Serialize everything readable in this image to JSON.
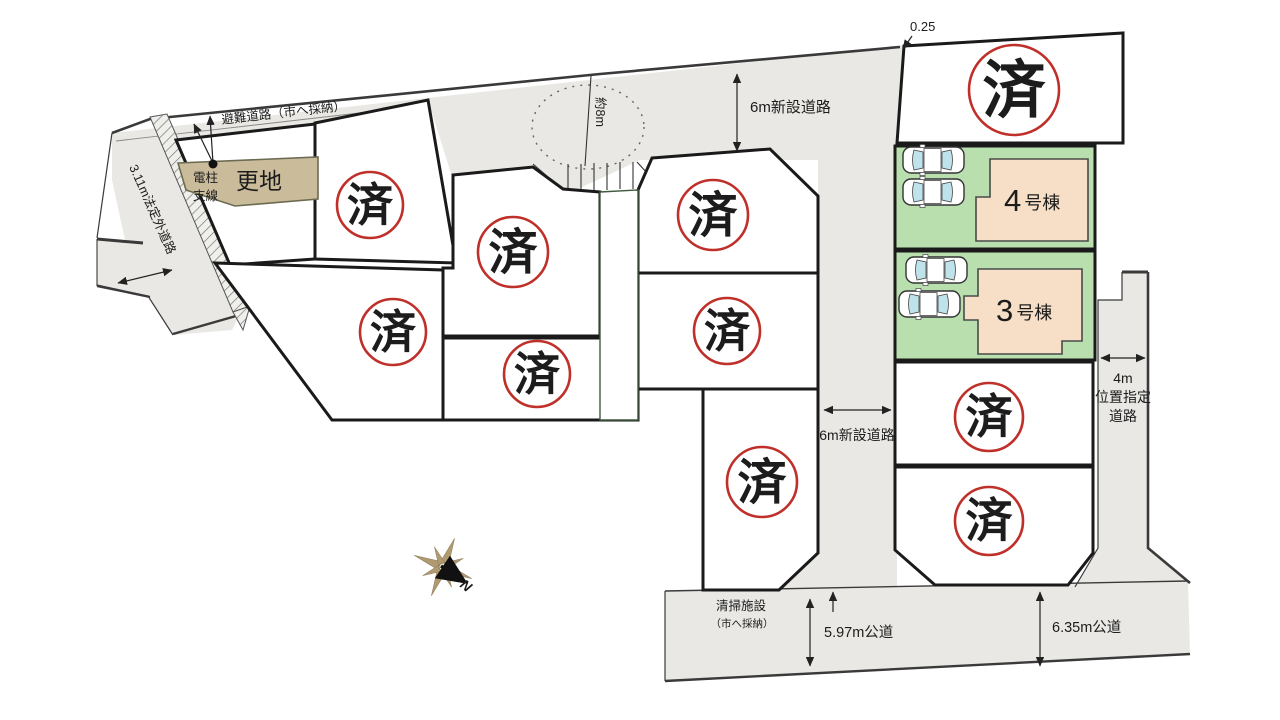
{
  "map": {
    "annotations": {
      "offset": "0.25",
      "road_new_top": "6m新設道路",
      "road_new_mid": "6m新設道路",
      "evacuation_road": "避難道路（市へ採納）",
      "outside_road": "3.11m法定外道路",
      "width_circle": "約8m",
      "pole_line1": "電柱",
      "pole_line2": "支線",
      "vacant": "更地",
      "right_road_line1": "4m",
      "right_road_line2": "位置指定",
      "right_road_line3": "道路",
      "public_road_left": "5.97m公道",
      "public_road_right": "6.35m公道",
      "cleaning_line1": "清掃施設",
      "cleaning_line2": "（市へ採納）",
      "north": "N"
    },
    "stamps": {
      "label": "済",
      "count": 10
    },
    "houses": [
      {
        "number": "4",
        "suffix": "号棟"
      },
      {
        "number": "3",
        "suffix": "号棟"
      }
    ],
    "lots": {
      "sold_count": 10,
      "available_count": 2,
      "vacant_parcel": "更地"
    },
    "colors": {
      "road": "#e9e8e5",
      "lot_available": "#b9dfae",
      "house": "#f6dfc6",
      "vacant_parcel": "#cabb9b",
      "stamp_red": "#c0302a",
      "compass_tan": "#b09a72"
    }
  }
}
